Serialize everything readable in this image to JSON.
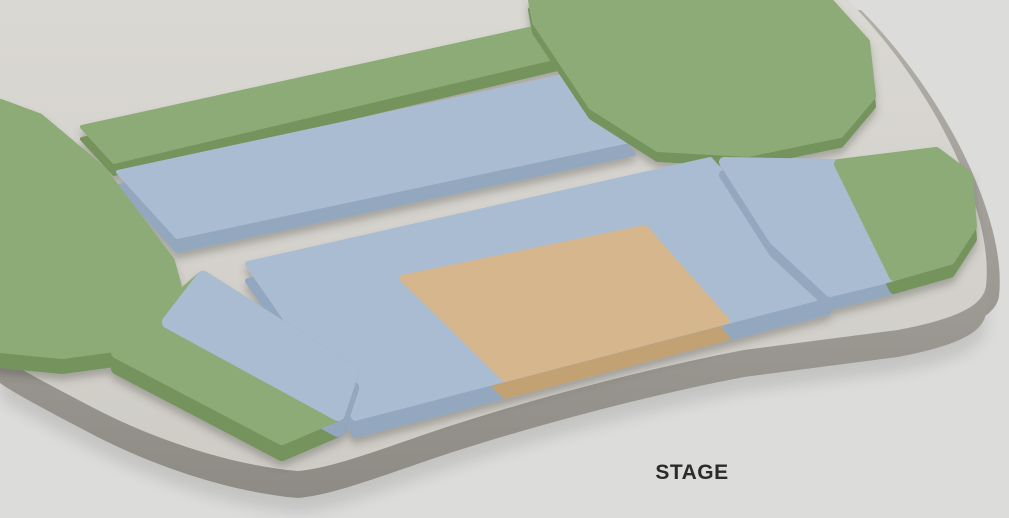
{
  "canvas": {
    "width": 1009,
    "height": 518,
    "background": "#dcdcdb"
  },
  "stage": {
    "label": "STAGE",
    "text_color": "#2b2b2b"
  },
  "palette": {
    "green_top": "#8cab77",
    "green_side": "#74945d",
    "blue_top": "#a9bcd2",
    "blue_side": "#93a7bf",
    "orange_top": "#d6b68c",
    "orange_side": "#c2a173",
    "floor_top_light": "#dad8d3",
    "floor_top_dark": "#cfccc6",
    "floor_wall_light": "#b2afa9",
    "floor_wall_dark": "#8e8b85",
    "background": "#dcdcdb"
  },
  "floor": {
    "path": "M 0 0 L 848 0 C 892 44 941 112 968 184 C 983 224 989 258 986 286 C 983 308 950 320 898 330 L 744 350 C 640 370 520 402 420 436 C 368 454 330 468 298 471 C 228 465 148 437 88 405 C 46 383 14 366 0 356 Z"
  },
  "sections": [
    {
      "id": "rear-terrace-green",
      "extrude": 12,
      "round": 4,
      "parts": [
        {
          "tier": "green",
          "points": [
            [
              82,
              127
            ],
            [
              538,
              27
            ],
            [
              566,
              55
            ],
            [
              114,
              162
            ]
          ]
        }
      ]
    },
    {
      "id": "rear-terrace-blue",
      "extrude": 14,
      "round": 4,
      "parts": [
        {
          "tier": "blue",
          "points": [
            [
              118,
              172
            ],
            [
              578,
              73
            ],
            [
              634,
              140
            ],
            [
              177,
              237
            ]
          ]
        }
      ]
    },
    {
      "id": "corner-right-green",
      "extrude": 10,
      "round": 8,
      "parts": [
        {
          "tier": "green",
          "points": [
            [
              532,
              0
            ],
            [
              828,
              0
            ],
            [
              866,
              42
            ],
            [
              872,
              96
            ],
            [
              840,
              134
            ],
            [
              748,
              153
            ],
            [
              658,
              148
            ],
            [
              592,
              106
            ],
            [
              536,
              22
            ]
          ]
        }
      ]
    },
    {
      "id": "side-left-green",
      "extrude": 15,
      "round": 14,
      "parts": [
        {
          "tier": "green",
          "points": [
            [
              0,
              106
            ],
            [
              38,
              120
            ],
            [
              100,
              172
            ],
            [
              168,
              262
            ],
            [
              180,
              306
            ],
            [
              152,
              340
            ],
            [
              62,
              352
            ],
            [
              0,
              346
            ]
          ]
        }
      ]
    },
    {
      "id": "main-floor",
      "extrude": 17,
      "round": 6,
      "parts": [
        {
          "tier": "blue",
          "points": [
            [
              248,
              264
            ],
            [
              710,
              160
            ],
            [
              828,
              295
            ],
            [
              355,
              418
            ]
          ]
        },
        {
          "tier": "orange",
          "points": [
            [
              402,
              278
            ],
            [
              645,
              228
            ],
            [
              727,
              321
            ],
            [
              505,
              379
            ]
          ]
        }
      ]
    },
    {
      "id": "side-right",
      "extrude": 13,
      "round": 10,
      "parts": [
        {
          "tier": "blue",
          "points": [
            [
              724,
              162
            ],
            [
              839,
              164
            ],
            [
              894,
              276
            ],
            [
              880,
              280
            ],
            [
              830,
              292
            ],
            [
              774,
              240
            ]
          ]
        },
        {
          "tier": "green",
          "points": [
            [
              839,
              164
            ],
            [
              936,
              152
            ],
            [
              968,
              176
            ],
            [
              972,
              226
            ],
            [
              950,
              260
            ],
            [
              894,
              276
            ]
          ]
        }
      ]
    },
    {
      "id": "front-left",
      "extrude": 16,
      "round": 14,
      "parts": [
        {
          "tier": "green",
          "points": [
            [
              203,
              278
            ],
            [
              352,
              372
            ],
            [
              338,
              414
            ],
            [
              282,
              438
            ],
            [
              118,
              352
            ]
          ]
        },
        {
          "tier": "blue",
          "points": [
            [
              203,
              278
            ],
            [
              352,
              372
            ],
            [
              338,
              414
            ],
            [
              169,
              322
            ]
          ]
        }
      ]
    }
  ]
}
